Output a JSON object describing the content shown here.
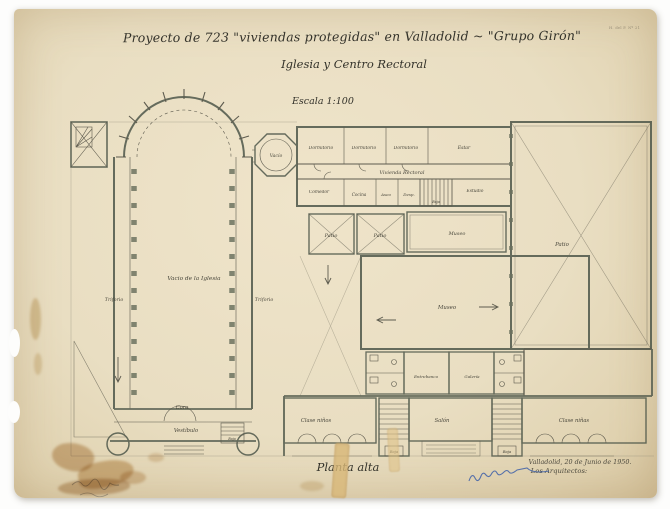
{
  "drawing": {
    "title": "Proyecto de 723 \"viviendas protegidas\" en Valladolid  ~  \"Grupo Girón\"",
    "subtitle": "Iglesia y Centro Rectoral",
    "scale_label": "Escala 1:100",
    "plan_label": "Planta alta",
    "date_line": "Valladolid, 20 de Junio de 1950.",
    "signed_by_label": "Los Arquitectos:",
    "sheet_number": "H. del P. Nº 21",
    "colors": {
      "paper": "#e9dec2",
      "ink": "#3a392f",
      "wall": "#4e574a",
      "signature_blue": "#3d5fa8",
      "stain_brown": "#b98a4e",
      "tape": "#d9b878"
    }
  },
  "rooms": [
    {
      "label": "Vacío",
      "x": 262,
      "y": 148,
      "s": 4.6
    },
    {
      "label": "Dormitorio",
      "x": 307,
      "y": 140,
      "s": 4.4
    },
    {
      "label": "Dormitorio",
      "x": 350,
      "y": 140,
      "s": 4.4
    },
    {
      "label": "Dormitorio",
      "x": 392,
      "y": 140,
      "s": 4.4
    },
    {
      "label": "Estar",
      "x": 450,
      "y": 140,
      "s": 4.6
    },
    {
      "label": "Vivienda Rectoral",
      "x": 388,
      "y": 165,
      "s": 5
    },
    {
      "label": "Comedor",
      "x": 305,
      "y": 184,
      "s": 4.4
    },
    {
      "label": "Cocina",
      "x": 345,
      "y": 187,
      "s": 4.2
    },
    {
      "label": "Aseo",
      "x": 372,
      "y": 187,
      "s": 4
    },
    {
      "label": "Desp.",
      "x": 395,
      "y": 187,
      "s": 4
    },
    {
      "label": "Baja",
      "x": 422,
      "y": 194,
      "s": 3.4
    },
    {
      "label": "Estudio",
      "x": 461,
      "y": 183,
      "s": 4.4
    },
    {
      "label": "Patio",
      "x": 317,
      "y": 228,
      "s": 5
    },
    {
      "label": "Patio",
      "x": 366,
      "y": 228,
      "s": 5
    },
    {
      "label": "Museo",
      "x": 443,
      "y": 226,
      "s": 5
    },
    {
      "label": "Patio",
      "x": 548,
      "y": 237,
      "s": 5.4
    },
    {
      "label": "Museo",
      "x": 433,
      "y": 300,
      "s": 5.4
    },
    {
      "label": "Vacio de la Iglesia",
      "x": 180,
      "y": 271,
      "s": 5.8
    },
    {
      "label": "Triforio",
      "x": 100,
      "y": 292,
      "s": 4.8
    },
    {
      "label": "Triforio",
      "x": 250,
      "y": 292,
      "s": 4.8
    },
    {
      "label": "Coro",
      "x": 168,
      "y": 400,
      "s": 5.2
    },
    {
      "label": "Vestíbulo",
      "x": 172,
      "y": 423,
      "s": 5.2
    },
    {
      "label": "Baja",
      "x": 218,
      "y": 431,
      "s": 3.4
    },
    {
      "label": "Entrebanco",
      "x": 412,
      "y": 369,
      "s": 4.1
    },
    {
      "label": "Galería",
      "x": 458,
      "y": 369,
      "s": 4.1
    },
    {
      "label": "Clase niños",
      "x": 302,
      "y": 413,
      "s": 5.2
    },
    {
      "label": "Salón",
      "x": 428,
      "y": 413,
      "s": 5.2
    },
    {
      "label": "Clase niñas",
      "x": 560,
      "y": 413,
      "s": 5.2
    },
    {
      "label": "Baja",
      "x": 380,
      "y": 444,
      "s": 3.8
    },
    {
      "label": "Baja",
      "x": 493,
      "y": 444,
      "s": 3.8
    }
  ]
}
